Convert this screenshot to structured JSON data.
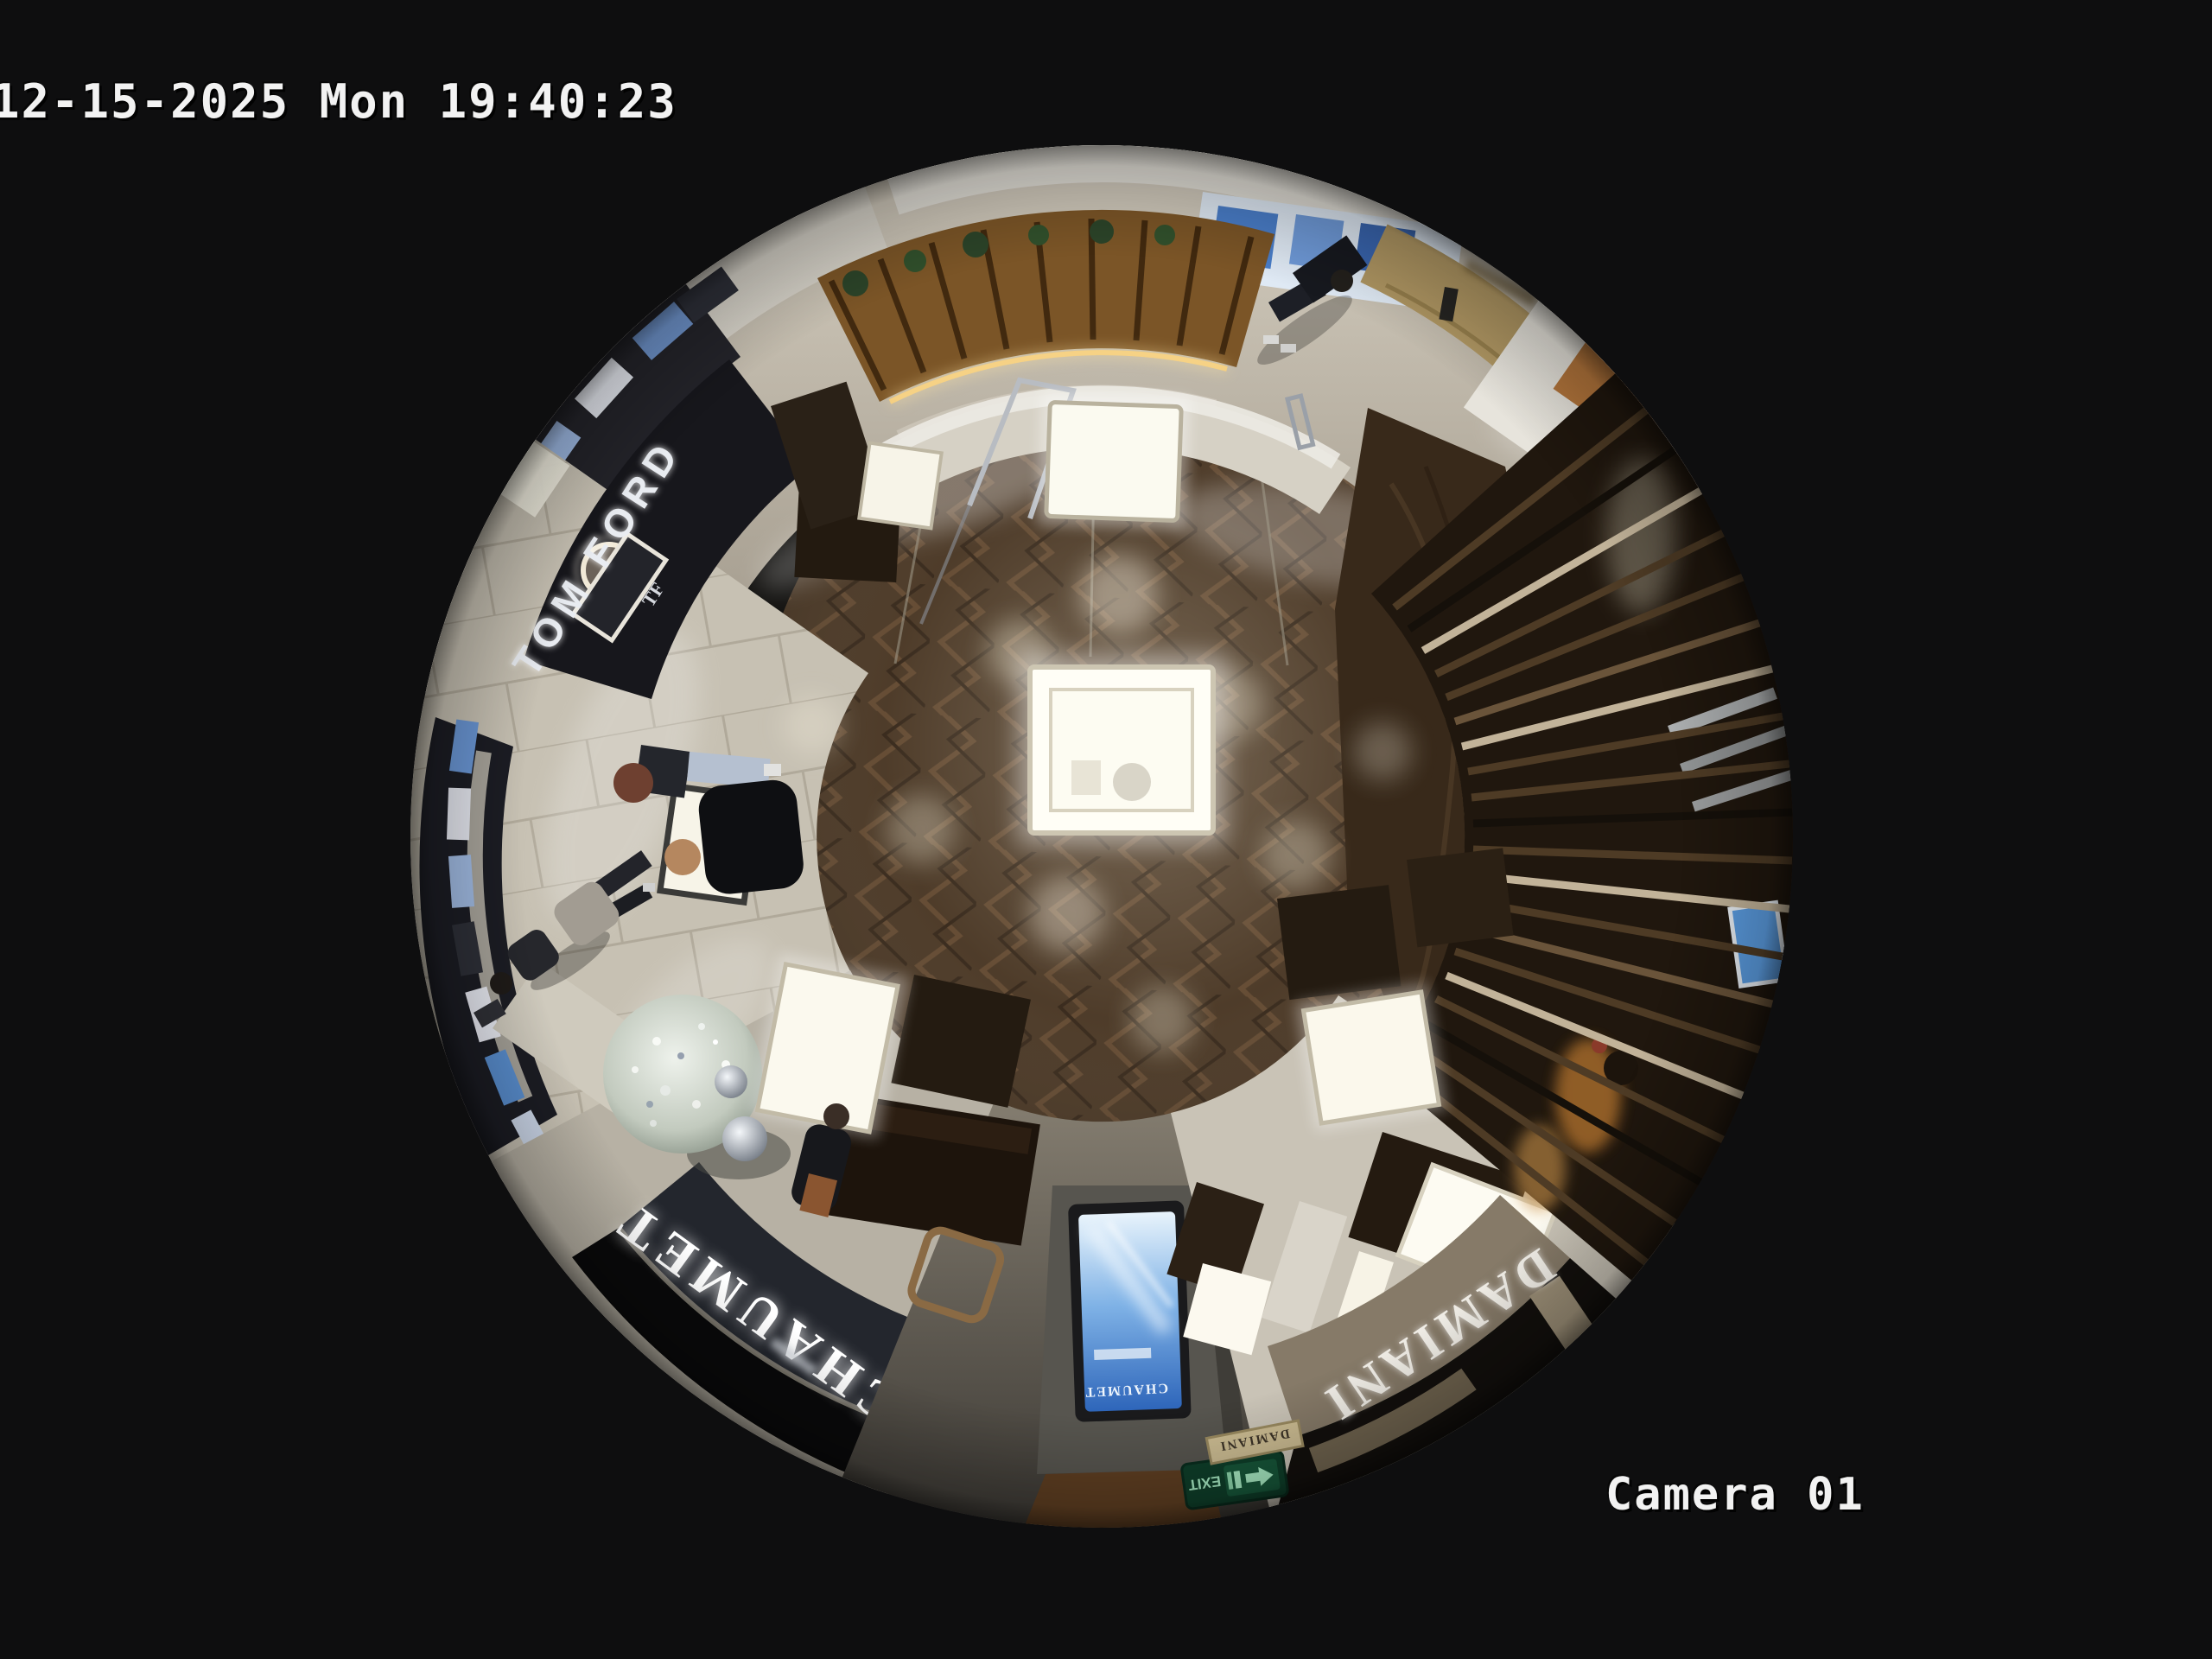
{
  "overlay": {
    "timestamp": "12-15-2025 Mon 19:40:23",
    "camera_label": "Camera 01"
  },
  "signs": {
    "tom_ford": "TOM FORD",
    "tf_monogram": "TF",
    "chaumet": "CHAUMET",
    "chaumet_screen": "CHAUMET",
    "damiani": "DAMIANI",
    "damiani_plaque": "DAMIANI",
    "exit": "EXIT"
  },
  "colors": {
    "background": "#0e0e0f",
    "overlay_text": "#f2f2f2",
    "wood_floor": "#43301e",
    "corridor_marble": "#b8b1a3",
    "chaumet_fascia": "#23262d",
    "damiani_fascia": "#867a68",
    "tom_ford_storefront": "#17171c",
    "kiosk_wood": "#7b5527",
    "screen_blue": "#2a62b8",
    "exit_green": "#0f3f2a",
    "display_case_light": "#fffef6"
  }
}
